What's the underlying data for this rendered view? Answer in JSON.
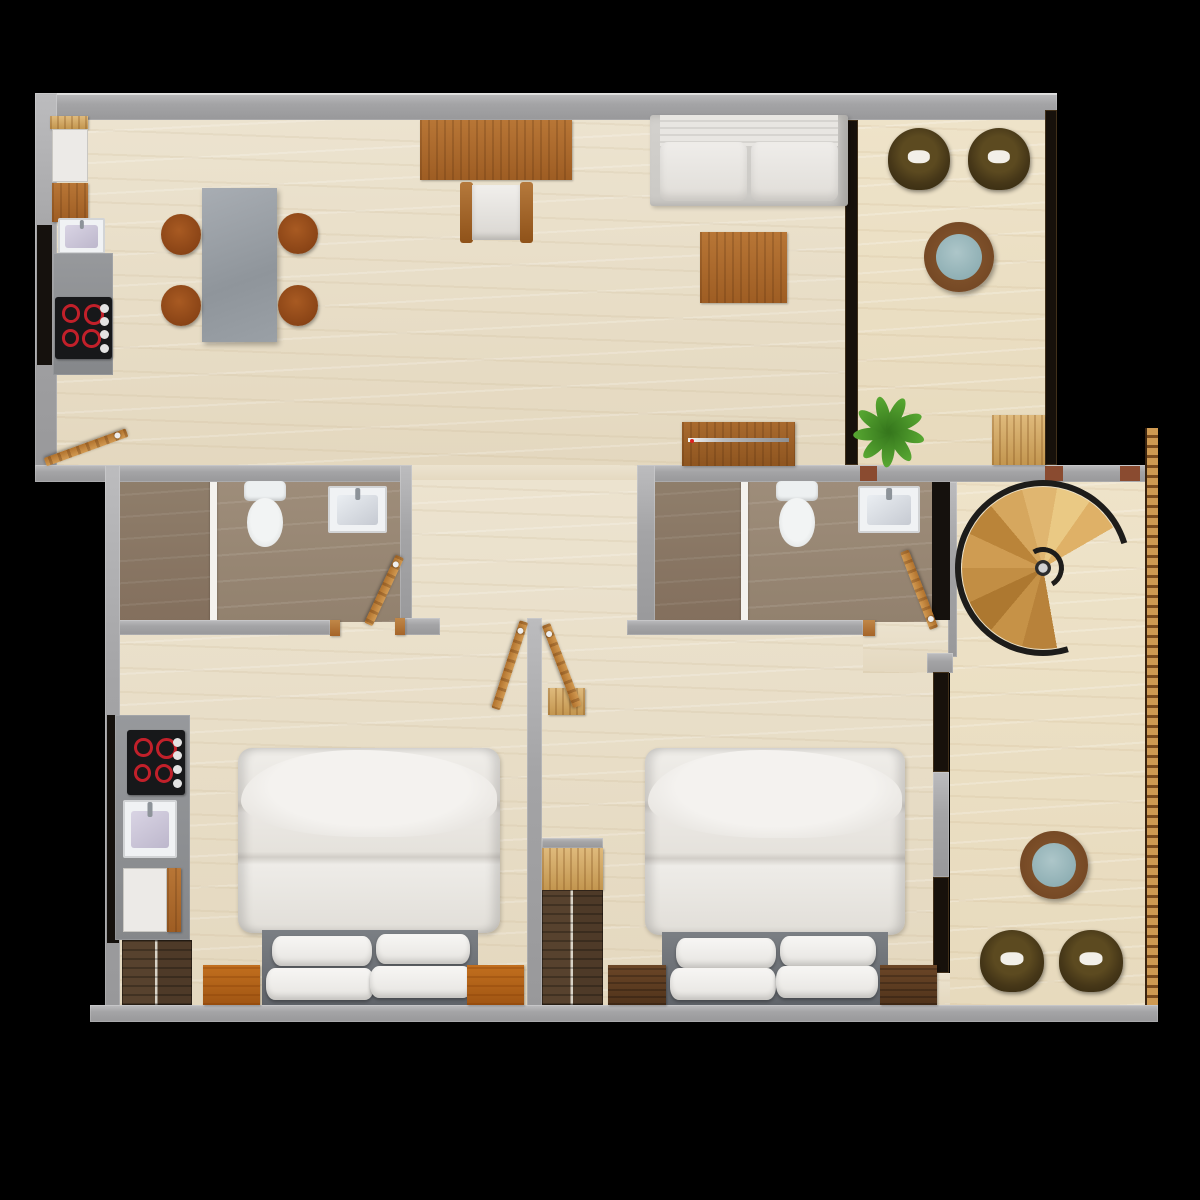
{
  "scene": {
    "type": "3d-floor-plan-top-view",
    "description": "rendered apartment floor plan: open kitchen-dining-living room with balcony at top, two bathrooms and spiral staircase in middle band, two bedrooms with terrace at bottom",
    "canvas": {
      "width": 1200,
      "height": 1200
    },
    "background": "#000000"
  },
  "palette": {
    "wall_gray": "#a6a6a8",
    "floor_marble": "#e9dfc9",
    "floor_bath_taupe": "#988774",
    "wood_mid": "#ad6b2e",
    "wood_light": "#d8b572",
    "wood_dark": "#5d3c24",
    "nightstand_orange": "#b4641e",
    "chair_rust": "#9a4d1c",
    "tub_chair_olive": "#46381a",
    "table_glass_blue": "#9db8bc",
    "sofa_linen": "#e7e4df",
    "bed_linen": "#ece9e5",
    "headboard_gray": "#6d7176",
    "stair_wood": "#d8a75e",
    "railing_black": "#1d1c1a",
    "hob_black": "#17181a",
    "burner_red": "#c2202a",
    "plant_green": "#3f7d22",
    "brick_accent": "#8a4b30"
  },
  "rooms": [
    {
      "name": "kitchen-dining-living",
      "area": "top-left"
    },
    {
      "name": "balcony-lounge",
      "area": "top-right"
    },
    {
      "name": "bathroom-1",
      "area": "middle-left"
    },
    {
      "name": "bathroom-2",
      "area": "middle-right"
    },
    {
      "name": "stair-hall",
      "area": "right"
    },
    {
      "name": "bedroom-1",
      "area": "bottom-left"
    },
    {
      "name": "bedroom-2",
      "area": "bottom-center"
    },
    {
      "name": "terrace",
      "area": "bottom-right"
    }
  ],
  "items": [
    {
      "n": "main-floor",
      "k": "floor-marble",
      "x": 57,
      "y": 120,
      "w": 788,
      "h": 346
    },
    {
      "n": "hallway-floor",
      "k": "floor-marble",
      "x": 412,
      "y": 465,
      "w": 225,
      "h": 17
    },
    {
      "n": "lower-floor",
      "k": "floor-marble",
      "x": 120,
      "y": 480,
      "w": 813,
      "h": 525
    },
    {
      "n": "balcony-floor",
      "k": "floor-marble2",
      "x": 858,
      "y": 120,
      "w": 187,
      "h": 345
    },
    {
      "n": "stair-terrace-floor",
      "k": "floor-marble2",
      "x": 950,
      "y": 482,
      "w": 195,
      "h": 523
    },
    {
      "n": "passage-floor",
      "k": "floor-marble",
      "x": 863,
      "y": 620,
      "w": 87,
      "h": 53
    },
    {
      "n": "bed2-floor-edge",
      "k": "floor-marble",
      "x": 933,
      "y": 973,
      "w": 17,
      "h": 32
    },
    {
      "n": "bath1-shower-floor",
      "k": "floor-shower",
      "x": 120,
      "y": 480,
      "w": 92,
      "h": 142
    },
    {
      "n": "bath1-floor",
      "k": "floor-bath",
      "x": 212,
      "y": 480,
      "w": 188,
      "h": 142
    },
    {
      "n": "bath2-shower-floor",
      "k": "floor-shower",
      "x": 655,
      "y": 480,
      "w": 88,
      "h": 142
    },
    {
      "n": "bath2-floor",
      "k": "floor-bath",
      "x": 743,
      "y": 480,
      "w": 189,
      "h": 142
    },
    {
      "n": "bath1-shower-screen",
      "k": "divider",
      "x": 210,
      "y": 481,
      "w": 7,
      "h": 140
    },
    {
      "n": "bath2-shower-screen",
      "k": "divider",
      "x": 741,
      "y": 481,
      "w": 7,
      "h": 140
    },
    {
      "n": "top-wall",
      "k": "wall",
      "o": "edge-top",
      "x": 35,
      "y": 93,
      "w": 1022,
      "h": 27
    },
    {
      "n": "left-wall-upper",
      "k": "wall",
      "x": 35,
      "y": 93,
      "w": 22,
      "h": 389
    },
    {
      "n": "mid-wall-left",
      "k": "wall",
      "x": 35,
      "y": 465,
      "w": 377,
      "h": 17
    },
    {
      "n": "mid-wall-right",
      "k": "wall",
      "x": 637,
      "y": 465,
      "w": 518,
      "h": 17
    },
    {
      "n": "bath1-right-wall",
      "k": "wall",
      "x": 400,
      "y": 465,
      "w": 12,
      "h": 170
    },
    {
      "n": "bath2-left-wall",
      "k": "wall",
      "x": 637,
      "y": 465,
      "w": 18,
      "h": 170
    },
    {
      "n": "bath1-bottom-wall",
      "k": "wall",
      "x": 105,
      "y": 620,
      "w": 225,
      "h": 15
    },
    {
      "n": "bath1-bottom-wall-b",
      "k": "wall",
      "x": 405,
      "y": 618,
      "w": 35,
      "h": 17
    },
    {
      "n": "bath2-bottom-wall",
      "k": "wall",
      "x": 627,
      "y": 620,
      "w": 236,
      "h": 15
    },
    {
      "n": "bedroom-divider-wall",
      "k": "wall",
      "x": 527,
      "y": 618,
      "w": 15,
      "h": 392
    },
    {
      "n": "left-wall-lower",
      "k": "wall",
      "x": 105,
      "y": 465,
      "w": 15,
      "h": 545
    },
    {
      "n": "bottom-wall",
      "k": "wall",
      "x": 90,
      "y": 1005,
      "w": 1068,
      "h": 17
    },
    {
      "n": "stair-left-wall",
      "k": "wall",
      "x": 948,
      "y": 482,
      "w": 9,
      "h": 175
    },
    {
      "n": "stub-wall",
      "k": "wall",
      "x": 927,
      "y": 653,
      "w": 26,
      "h": 20
    },
    {
      "n": "bed2-window-pier",
      "k": "wall",
      "x": 933,
      "y": 772,
      "w": 16,
      "h": 105
    },
    {
      "n": "closet-top-band",
      "k": "wall",
      "x": 542,
      "y": 838,
      "w": 61,
      "h": 10
    },
    {
      "n": "door-jamb-1",
      "k": "wood",
      "t": "mid",
      "x": 330,
      "y": 620,
      "w": 10,
      "h": 16
    },
    {
      "n": "door-jamb-2",
      "k": "wood",
      "t": "mid",
      "x": 395,
      "y": 618,
      "w": 10,
      "h": 17
    },
    {
      "n": "door-jamb-3",
      "k": "wood",
      "t": "mid",
      "x": 863,
      "y": 620,
      "w": 12,
      "h": 16
    },
    {
      "n": "wall-brick-1",
      "k": "rect",
      "c": "#8a4b30",
      "x": 860,
      "y": 466,
      "w": 17,
      "h": 15
    },
    {
      "n": "wall-brick-2",
      "k": "rect",
      "c": "#8a4b30",
      "x": 1045,
      "y": 466,
      "w": 18,
      "h": 15
    },
    {
      "n": "wall-brick-3",
      "k": "rect",
      "c": "#8a4b30",
      "x": 1120,
      "y": 466,
      "w": 20,
      "h": 15
    },
    {
      "n": "window-living-balcony",
      "k": "window",
      "x": 845,
      "y": 120,
      "w": 13,
      "h": 345
    },
    {
      "n": "window-balcony-right",
      "k": "window",
      "x": 1045,
      "y": 110,
      "w": 12,
      "h": 355
    },
    {
      "n": "kitchen-tall-unit",
      "k": "black",
      "x": 37,
      "y": 225,
      "w": 15,
      "h": 140
    },
    {
      "n": "bath2-dark-cabinet",
      "k": "black",
      "x": 932,
      "y": 482,
      "w": 18,
      "h": 138
    },
    {
      "n": "bed2-window-a",
      "k": "window",
      "x": 933,
      "y": 672,
      "w": 16,
      "h": 100
    },
    {
      "n": "bed2-window-b",
      "k": "window",
      "x": 933,
      "y": 877,
      "w": 16,
      "h": 96
    },
    {
      "n": "kitchenette-dark-panel",
      "k": "black",
      "x": 107,
      "y": 715,
      "w": 12,
      "h": 228
    },
    {
      "n": "fridge-counter-wood",
      "k": "wood",
      "t": "light",
      "x": 50,
      "y": 116,
      "w": 38,
      "h": 13
    },
    {
      "n": "fridge",
      "k": "white-box",
      "x": 52,
      "y": 129,
      "w": 36,
      "h": 53
    },
    {
      "n": "kitchen-cabinet-wood",
      "k": "wood",
      "x": 52,
      "y": 183,
      "w": 36,
      "h": 39
    },
    {
      "n": "kitchen-sink",
      "k": "sink",
      "t": "k",
      "x": 58,
      "y": 218,
      "w": 47,
      "h": 36
    },
    {
      "n": "kitchen-counter",
      "k": "counter",
      "x": 53,
      "y": 253,
      "w": 60,
      "h": 122
    },
    {
      "n": "kitchen-hob",
      "k": "hob",
      "x": 55,
      "y": 297,
      "w": 57,
      "h": 62
    },
    {
      "n": "dining-table",
      "k": "stone-table",
      "x": 202,
      "y": 188,
      "w": 75,
      "h": 154
    },
    {
      "n": "dining-chair-1",
      "k": "chair-round",
      "x": 161,
      "y": 214,
      "w": 40,
      "h": 41
    },
    {
      "n": "dining-chair-2",
      "k": "chair-round",
      "x": 278,
      "y": 213,
      "w": 40,
      "h": 41
    },
    {
      "n": "dining-chair-3",
      "k": "chair-round",
      "x": 161,
      "y": 285,
      "w": 40,
      "h": 41
    },
    {
      "n": "dining-chair-4",
      "k": "chair-round",
      "x": 278,
      "y": 285,
      "w": 40,
      "h": 41
    },
    {
      "n": "console-table",
      "k": "wood",
      "x": 420,
      "y": 120,
      "w": 152,
      "h": 60
    },
    {
      "n": "desk-chair",
      "k": "desk-chair",
      "x": 460,
      "y": 182,
      "w": 73,
      "h": 61
    },
    {
      "n": "sofa",
      "k": "sofa",
      "x": 650,
      "y": 115,
      "w": 198,
      "h": 91
    },
    {
      "n": "coffee-table",
      "k": "wood",
      "x": 700,
      "y": 232,
      "w": 87,
      "h": 71
    },
    {
      "n": "tv-console",
      "k": "tv",
      "x": 682,
      "y": 422,
      "w": 113,
      "h": 44
    },
    {
      "n": "balcony-chair-1",
      "k": "tub-chair",
      "x": 888,
      "y": 128,
      "w": 62,
      "h": 62
    },
    {
      "n": "balcony-chair-2",
      "k": "tub-chair",
      "x": 968,
      "y": 128,
      "w": 62,
      "h": 62
    },
    {
      "n": "balcony-table",
      "k": "round-table",
      "x": 924,
      "y": 222,
      "w": 70,
      "h": 70
    },
    {
      "n": "decor-wood-panel",
      "k": "wood",
      "t": "light",
      "x": 992,
      "y": 415,
      "w": 53,
      "h": 50
    },
    {
      "n": "bath1-toilet",
      "k": "toilet",
      "x": 243,
      "y": 481,
      "w": 44,
      "h": 67
    },
    {
      "n": "bath1-sink",
      "k": "sink",
      "x": 328,
      "y": 486,
      "w": 59,
      "h": 47
    },
    {
      "n": "bath2-toilet",
      "k": "toilet",
      "x": 775,
      "y": 481,
      "w": 44,
      "h": 67
    },
    {
      "n": "bath2-sink",
      "k": "sink",
      "x": 858,
      "y": 486,
      "w": 62,
      "h": 47
    },
    {
      "n": "bed1-duvet",
      "k": "duvet",
      "x": 238,
      "y": 748,
      "w": 262,
      "h": 185
    },
    {
      "n": "bed1-headboard",
      "k": "headboard",
      "x": 262,
      "y": 930,
      "w": 216,
      "h": 75
    },
    {
      "n": "bed1-pillow-1",
      "k": "pillow",
      "x": 272,
      "y": 936,
      "w": 100,
      "h": 30
    },
    {
      "n": "bed1-pillow-2",
      "k": "pillow",
      "x": 376,
      "y": 934,
      "w": 94,
      "h": 30
    },
    {
      "n": "bed1-pillow-3",
      "k": "pillow",
      "x": 266,
      "y": 968,
      "w": 108,
      "h": 32
    },
    {
      "n": "bed1-pillow-4",
      "k": "pillow",
      "x": 370,
      "y": 966,
      "w": 102,
      "h": 32
    },
    {
      "n": "bed1-nightstand-left",
      "k": "wood",
      "t": "orange",
      "x": 203,
      "y": 965,
      "w": 57,
      "h": 40
    },
    {
      "n": "bed1-nightstand-right",
      "k": "wood",
      "t": "orange",
      "x": 467,
      "y": 965,
      "w": 57,
      "h": 40
    },
    {
      "n": "bed1-wardrobe",
      "k": "wardrobe",
      "x": 122,
      "y": 940,
      "w": 70,
      "h": 65
    },
    {
      "n": "kitchenette-counter",
      "k": "counter",
      "x": 115,
      "y": 715,
      "w": 75,
      "h": 225
    },
    {
      "n": "kitchenette-hob",
      "k": "hob",
      "x": 127,
      "y": 730,
      "w": 58,
      "h": 65
    },
    {
      "n": "kitchenette-sink",
      "k": "sink",
      "t": "k",
      "x": 123,
      "y": 800,
      "w": 54,
      "h": 58
    },
    {
      "n": "kitchenette-cabinet",
      "k": "white-box",
      "x": 123,
      "y": 868,
      "w": 44,
      "h": 64
    },
    {
      "n": "kitchenette-cabinet-edge",
      "k": "wood",
      "x": 167,
      "y": 868,
      "w": 14,
      "h": 64
    },
    {
      "n": "bed2-duvet",
      "k": "duvet",
      "x": 645,
      "y": 748,
      "w": 260,
      "h": 187
    },
    {
      "n": "bed2-headboard",
      "k": "headboard",
      "x": 662,
      "y": 932,
      "w": 226,
      "h": 73
    },
    {
      "n": "bed2-pillow-1",
      "k": "pillow",
      "x": 676,
      "y": 938,
      "w": 100,
      "h": 30
    },
    {
      "n": "bed2-pillow-2",
      "k": "pillow",
      "x": 780,
      "y": 936,
      "w": 96,
      "h": 30
    },
    {
      "n": "bed2-pillow-3",
      "k": "pillow",
      "x": 670,
      "y": 968,
      "w": 106,
      "h": 32
    },
    {
      "n": "bed2-pillow-4",
      "k": "pillow",
      "x": 776,
      "y": 966,
      "w": 102,
      "h": 32
    },
    {
      "n": "bed2-nightstand-left",
      "k": "wood",
      "t": "dark",
      "x": 608,
      "y": 965,
      "w": 58,
      "h": 40
    },
    {
      "n": "bed2-nightstand-right",
      "k": "wood",
      "t": "dark",
      "x": 880,
      "y": 965,
      "w": 57,
      "h": 40
    },
    {
      "n": "bed2-closet-shelf",
      "k": "wood",
      "t": "light",
      "x": 542,
      "y": 848,
      "w": 61,
      "h": 42
    },
    {
      "n": "bed2-wardrobe",
      "k": "wardrobe",
      "x": 542,
      "y": 890,
      "w": 61,
      "h": 115
    },
    {
      "n": "wall-shelf",
      "k": "wood",
      "t": "light",
      "x": 548,
      "y": 688,
      "w": 37,
      "h": 27
    },
    {
      "n": "terrace-table",
      "k": "round-table",
      "x": 1020,
      "y": 831,
      "w": 68,
      "h": 68
    },
    {
      "n": "terrace-chair-1",
      "k": "tub-chair",
      "x": 980,
      "y": 930,
      "w": 64,
      "h": 62
    },
    {
      "n": "terrace-chair-2",
      "k": "tub-chair",
      "x": 1059,
      "y": 930,
      "w": 64,
      "h": 62
    },
    {
      "n": "terrace-railing",
      "k": "railing",
      "x": 1145,
      "y": 428,
      "w": 13,
      "h": 577
    },
    {
      "n": "spiral-staircase",
      "k": "spiral",
      "x": 955,
      "y": 480,
      "w": 176,
      "h": 176
    },
    {
      "n": "potted-plant",
      "k": "plant",
      "x": 853,
      "y": 391,
      "w": 80,
      "h": 80
    },
    {
      "n": "entry-door",
      "k": "door",
      "x": 127,
      "y": 432,
      "l": 87,
      "a": 160
    },
    {
      "n": "bath1-door",
      "k": "door",
      "x": 400,
      "y": 556,
      "l": 75,
      "a": 115
    },
    {
      "n": "bath2-door",
      "k": "door",
      "x": 934,
      "y": 628,
      "l": 83,
      "a": -111
    },
    {
      "n": "bed1-door",
      "k": "door",
      "x": 524,
      "y": 621,
      "l": 92,
      "a": 108
    },
    {
      "n": "bed2-door",
      "k": "door",
      "x": 546,
      "y": 624,
      "l": 88,
      "a": 69
    }
  ]
}
